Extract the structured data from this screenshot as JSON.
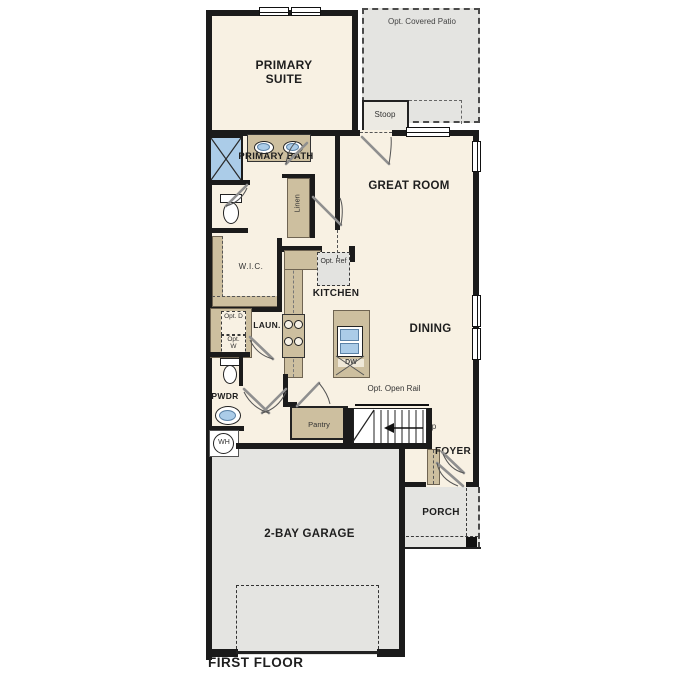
{
  "title": "FIRST FLOOR",
  "colors": {
    "cream": "#f8f1e3",
    "tan": "#cdbf9f",
    "tanline": "#6f6452",
    "gray": "#e4e4e1",
    "blue": "#abccE8",
    "wall": "#1b1b1b"
  },
  "rooms": {
    "primary_suite": "PRIMARY SUITE",
    "primary_bath": "PRIMARY BATH",
    "wic": "W.I.C.",
    "linen": "Linen",
    "great_room": "GREAT ROOM",
    "kitchen": "KITCHEN",
    "dining": "DINING",
    "laundry": "LAUN.",
    "powder": "PWDR",
    "pantry": "Pantry",
    "stoop": "Stoop",
    "foyer": "FOYER",
    "porch": "PORCH",
    "garage": "2-BAY GARAGE"
  },
  "options": {
    "covered_patio": "Opt. Covered Patio",
    "ref": "Opt. Ref",
    "dryer": "Opt. D",
    "washer": "Opt. W",
    "open_rail": "Opt. Open Rail"
  },
  "fixtures": {
    "water_heater": "WH",
    "dishwasher": "DW",
    "stairs_direction": "Up"
  }
}
